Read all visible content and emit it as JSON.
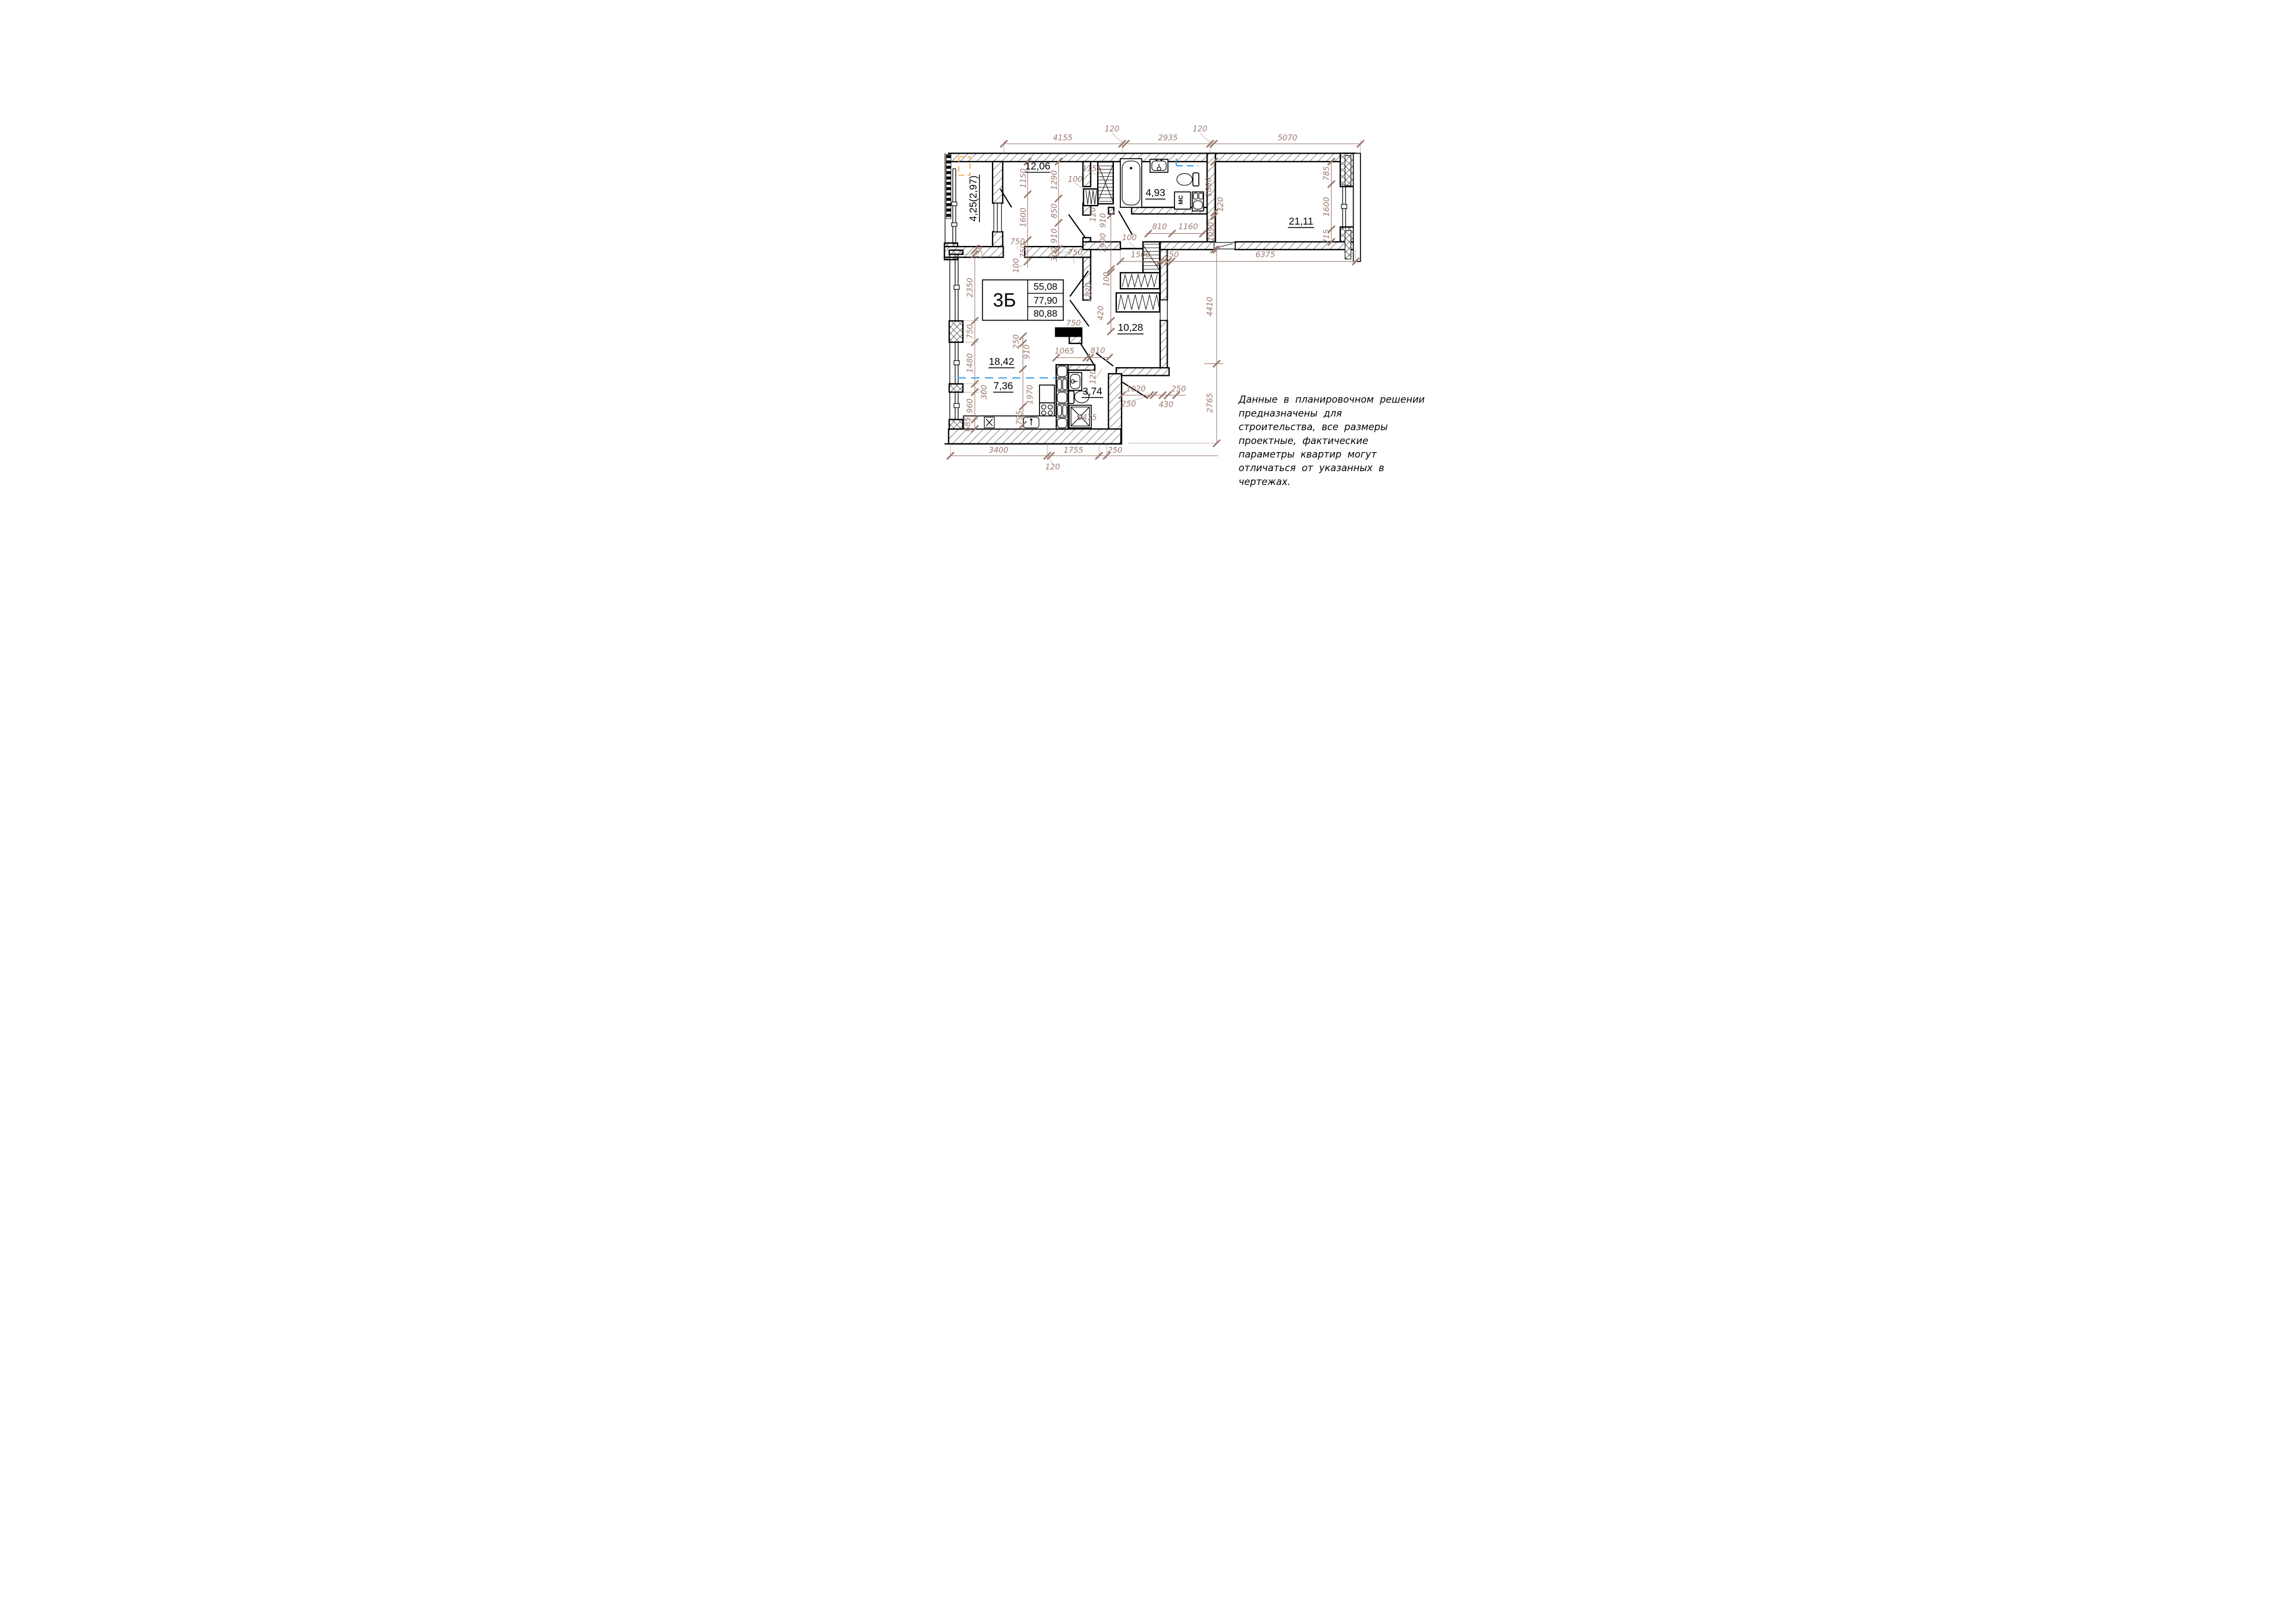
{
  "unit_table": {
    "type": "3Б",
    "rows": [
      "55,08",
      "77,90",
      "80,88"
    ]
  },
  "rooms": {
    "bedroom": "12,06",
    "bathroom": "4,93",
    "living_big": "21,11",
    "hall": "10,28",
    "living": "18,42",
    "kitchen": "7,36",
    "wc": "3,74",
    "balcony": "4,25(2,97)"
  },
  "labels": {
    "washing_machine": "МС"
  },
  "dims": {
    "top": [
      "4155",
      "120",
      "2935",
      "120",
      "5070"
    ],
    "bottom": [
      "3400",
      "120",
      "1755",
      "250"
    ],
    "left": [
      "150",
      "2350",
      "750",
      "1480",
      "300",
      "960",
      "685"
    ],
    "balcony_col": [
      "1150",
      "1600",
      "750",
      "100"
    ],
    "room12_col": [
      "1290",
      "850",
      "910",
      "300"
    ],
    "d750": [
      "750",
      "750",
      "750"
    ],
    "bath_top": [
      "100",
      "1155",
      "120",
      "910"
    ],
    "lobby": [
      "810",
      "1160"
    ],
    "bath_col": [
      "1890",
      "120",
      "1090"
    ],
    "r21_col": [
      "785",
      "1600",
      "715"
    ],
    "hall_line": [
      "100",
      "1500",
      "250",
      "6375"
    ],
    "hall_col": [
      "1900",
      "100",
      "1820",
      "420"
    ],
    "kitchen_col": [
      "250",
      "910",
      "1970",
      "795"
    ],
    "wc_line": [
      "1065",
      "810",
      "120"
    ],
    "wc_inner": [
      "1475"
    ],
    "br_line": [
      "1020",
      "250",
      "430",
      "250"
    ],
    "right_col": [
      "4410",
      "2765"
    ]
  },
  "disclaimer": {
    "lines": [
      "Данные в планировочном решении",
      "предназначены для",
      "строительства, все размеры",
      "проектные, фактические",
      "параметры квартир могут",
      "отличаться от указанных в",
      "чертежах."
    ]
  },
  "colors": {
    "dimension": "#9b7a6f",
    "wall": "#000000",
    "utility_blue": "#2f9bef",
    "accent_orange": "#efa23b"
  }
}
